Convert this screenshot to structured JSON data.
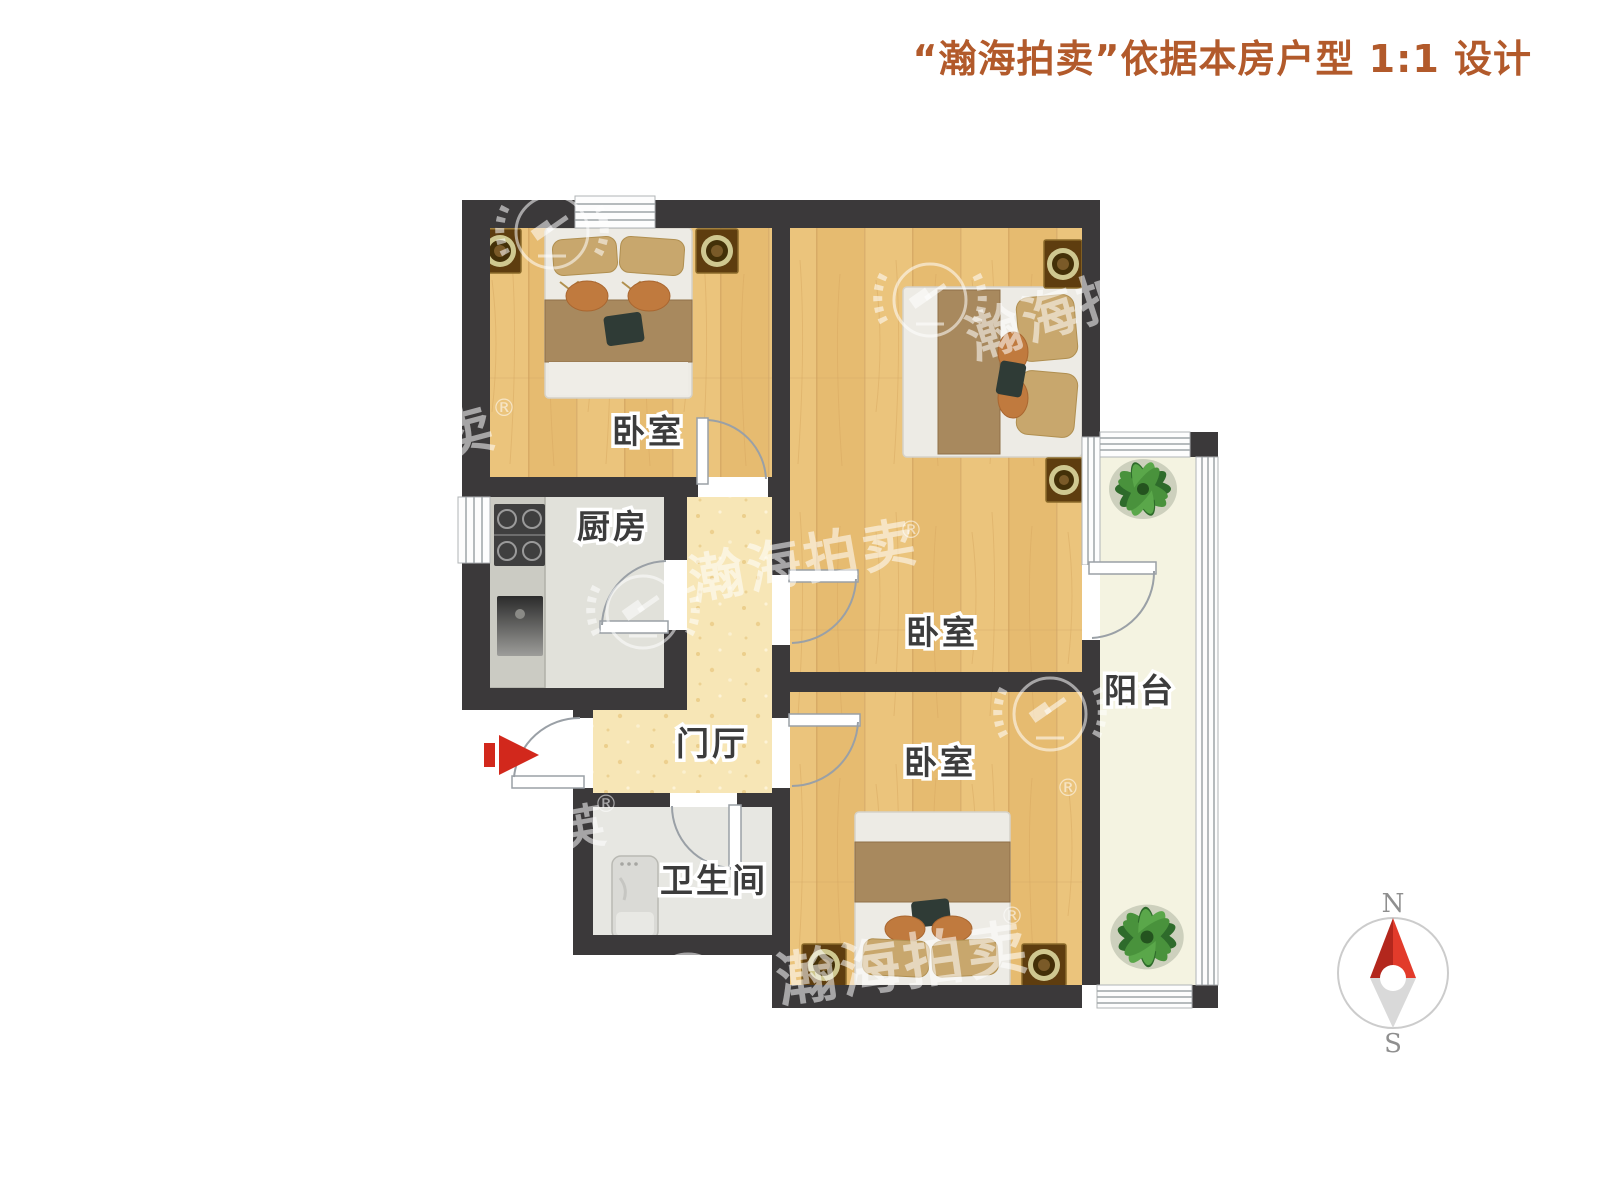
{
  "title": {
    "text": "“瀚海拍卖”依据本房户型 1:1 设计"
  },
  "rooms": {
    "bedroom1": {
      "label": "卧室"
    },
    "bedroom2": {
      "label": "卧室"
    },
    "bedroom3": {
      "label": "卧室"
    },
    "kitchen": {
      "label": "厨房"
    },
    "hall": {
      "label": "门厅"
    },
    "bathroom": {
      "label": "卫生间"
    },
    "balcony": {
      "label": "阳台"
    }
  },
  "compass": {
    "north": "N",
    "south": "S"
  },
  "watermark": {
    "brand": "瀚海拍卖",
    "registered": "®",
    "partial_left": "卖",
    "partial_bottom": "英"
  },
  "colors": {
    "wall": "#3b393a",
    "accent": "#b25a2b",
    "wood": "#ebc47c",
    "hall": "#f7e6b6",
    "kitchen": "#e1e1da",
    "bath": "#e7e7e2",
    "balcony": "#f4f3e1",
    "blanket": "#a8895e",
    "pillow": "#c8a76d",
    "cushion": "#c07a3e",
    "nightstand": "#5e3d0f",
    "plant": "#2e6b2b",
    "red": "#d2281c",
    "doorline": "#9aa0a6"
  }
}
